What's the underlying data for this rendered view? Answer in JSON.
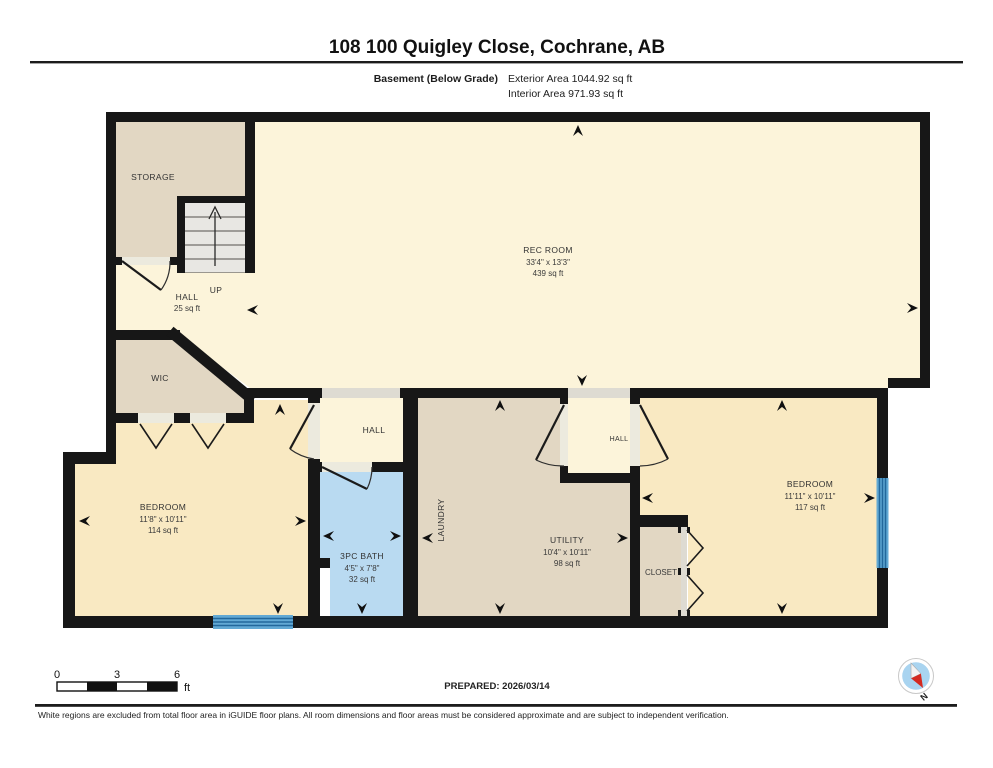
{
  "header": {
    "title": "108 100 Quigley Close, Cochrane, AB",
    "floor_label": "Basement (Below Grade)",
    "exterior_area": "Exterior Area 1044.92 sq ft",
    "interior_area": "Interior Area 971.93 sq ft"
  },
  "rooms": {
    "storage": {
      "label": "STORAGE"
    },
    "stairs": {
      "direction_label": "UP"
    },
    "hall_main": {
      "label": "HALL",
      "area": "25 sq ft"
    },
    "rec_room": {
      "label": "REC ROOM",
      "dims": "33'4\" x 13'3\"",
      "area": "439 sq ft"
    },
    "wic": {
      "label": "WIC"
    },
    "bedroom_left": {
      "label": "BEDROOM",
      "dims": "11'8\" x 10'11\"",
      "area": "114 sq ft"
    },
    "hall_mid": {
      "label": "HALL"
    },
    "bath": {
      "label": "3PC BATH",
      "dims": "4'5\" x 7'8\"",
      "area": "32 sq ft"
    },
    "laundry": {
      "label": "LAUNDRY"
    },
    "utility": {
      "label": "UTILITY",
      "dims": "10'4\" x 10'11\"",
      "area": "98 sq ft"
    },
    "hall_small": {
      "label": "HALL"
    },
    "closet": {
      "label": "CLOSET"
    },
    "bedroom_right": {
      "label": "BEDROOM",
      "dims": "11'11\" x 10'11\"",
      "area": "117 sq ft"
    }
  },
  "scale_bar": {
    "ticks": [
      "0",
      "3",
      "6"
    ],
    "unit": "ft"
  },
  "footer": {
    "prepared": "PREPARED: 2026/03/14",
    "disclaimer": "White regions are excluded from total floor area in iGUIDE floor plans. All room dimensions and floor areas must be considered approximate and are subject to independent verification.",
    "compass_north_label": "N"
  },
  "colors": {
    "wall": "#171717",
    "room_cream": "#fcf4da",
    "room_tan": "#e2d7c3",
    "room_yellow": "#f9e9c2",
    "room_bath_blue": "#b9daf1",
    "window_blue": "#62a9d4",
    "compass_blue": "#a9d4f0",
    "compass_red": "#d42a20"
  }
}
